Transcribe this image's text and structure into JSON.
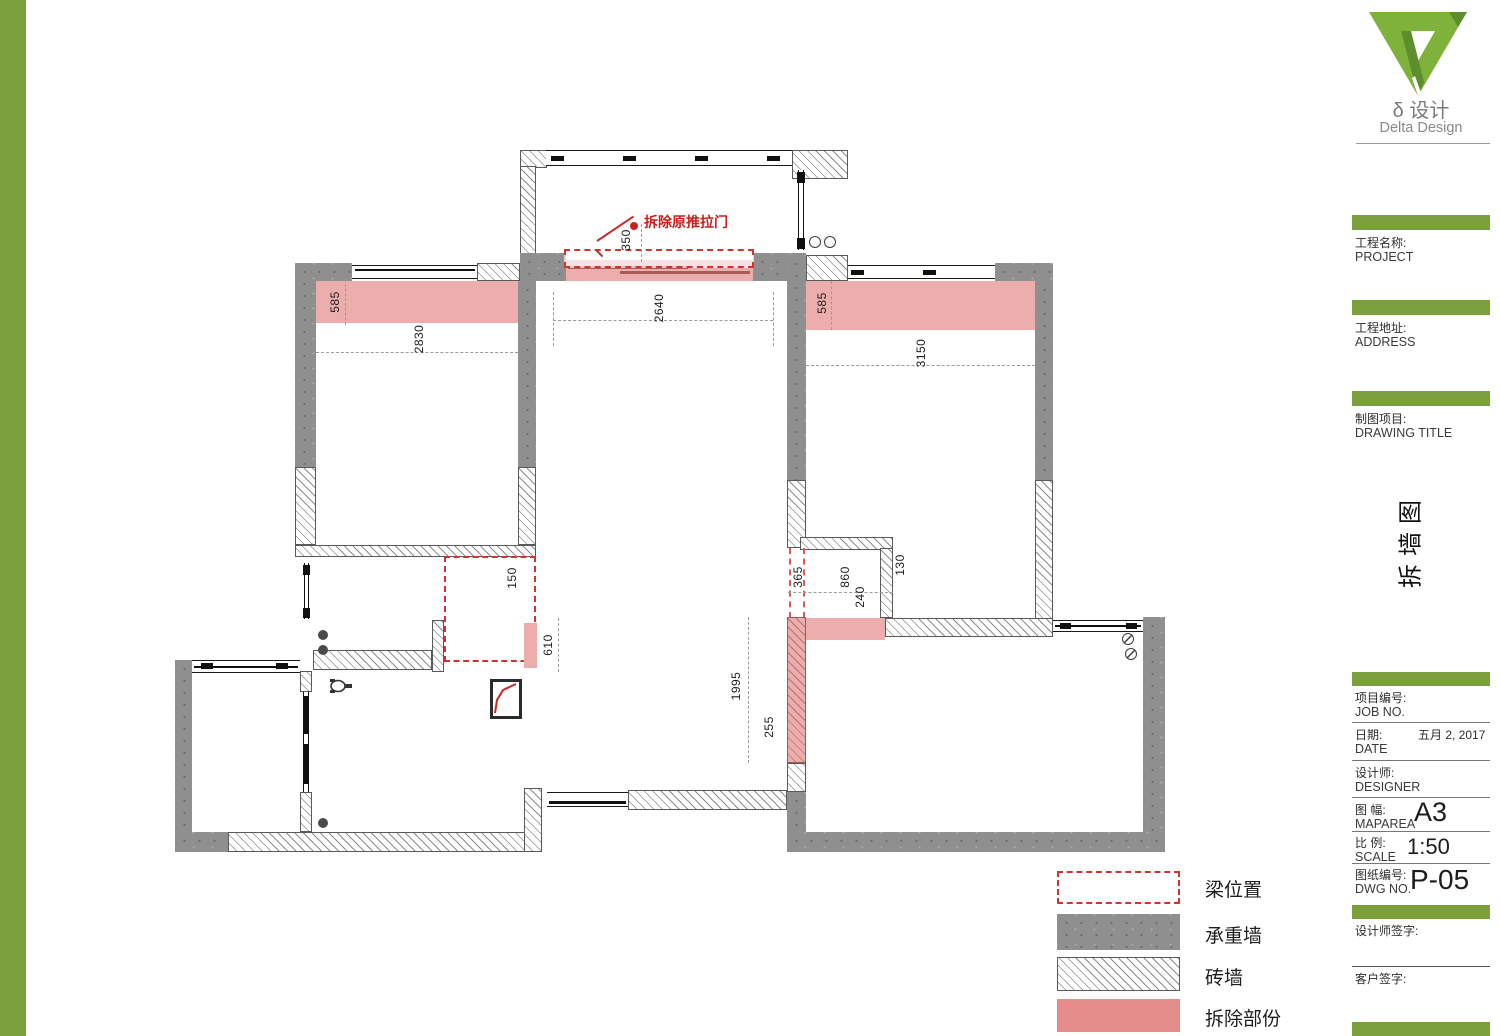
{
  "colors": {
    "accent_green": "#7aa03c",
    "demolish_pink": "#ecaeac",
    "beam_red": "#d0342e",
    "wall_gray": "#8f8f8f"
  },
  "logo": {
    "cn": "δ 设计",
    "en": "Delta Design"
  },
  "titleblock": {
    "project": {
      "cn": "工程名称:",
      "en": "PROJECT"
    },
    "address": {
      "cn": "工程地址:",
      "en": "ADDRESS"
    },
    "drawing": {
      "cn": "制图项目:",
      "en": "DRAWING TITLE"
    },
    "sheet_title_vertical": "拆墙图",
    "job": {
      "cn": "项目编号:",
      "en": "JOB NO."
    },
    "date": {
      "cn": "日期:",
      "en": "DATE",
      "value": "五月 2, 2017"
    },
    "designer": {
      "cn": "设计师:",
      "en": "DESIGNER"
    },
    "maparea": {
      "cn": "图 幅:",
      "en": "MAPAREA",
      "value": "A3"
    },
    "scale": {
      "cn": "比 例:",
      "en": "SCALE",
      "value": "1:50"
    },
    "dwg": {
      "cn": "图纸编号:",
      "en": "DWG NO.",
      "value": "P-05"
    },
    "designer_sign": "设计师签字:",
    "client_sign": "客户签字:"
  },
  "legend": {
    "beam": "梁位置",
    "bearing_wall": "承重墙",
    "brick_wall": "砖墙",
    "demolish": "拆除部份"
  },
  "plan": {
    "annotation_demolish_door": "拆除原推拉门",
    "dims": {
      "d350": "350",
      "d585l": "585",
      "d2830": "2830",
      "d2640": "2640",
      "d585r": "585",
      "d3150": "3150",
      "d150": "150",
      "d610": "610",
      "d365": "365",
      "d860": "860",
      "d240": "240",
      "d130": "130",
      "d1995": "1995",
      "d255": "255"
    }
  }
}
